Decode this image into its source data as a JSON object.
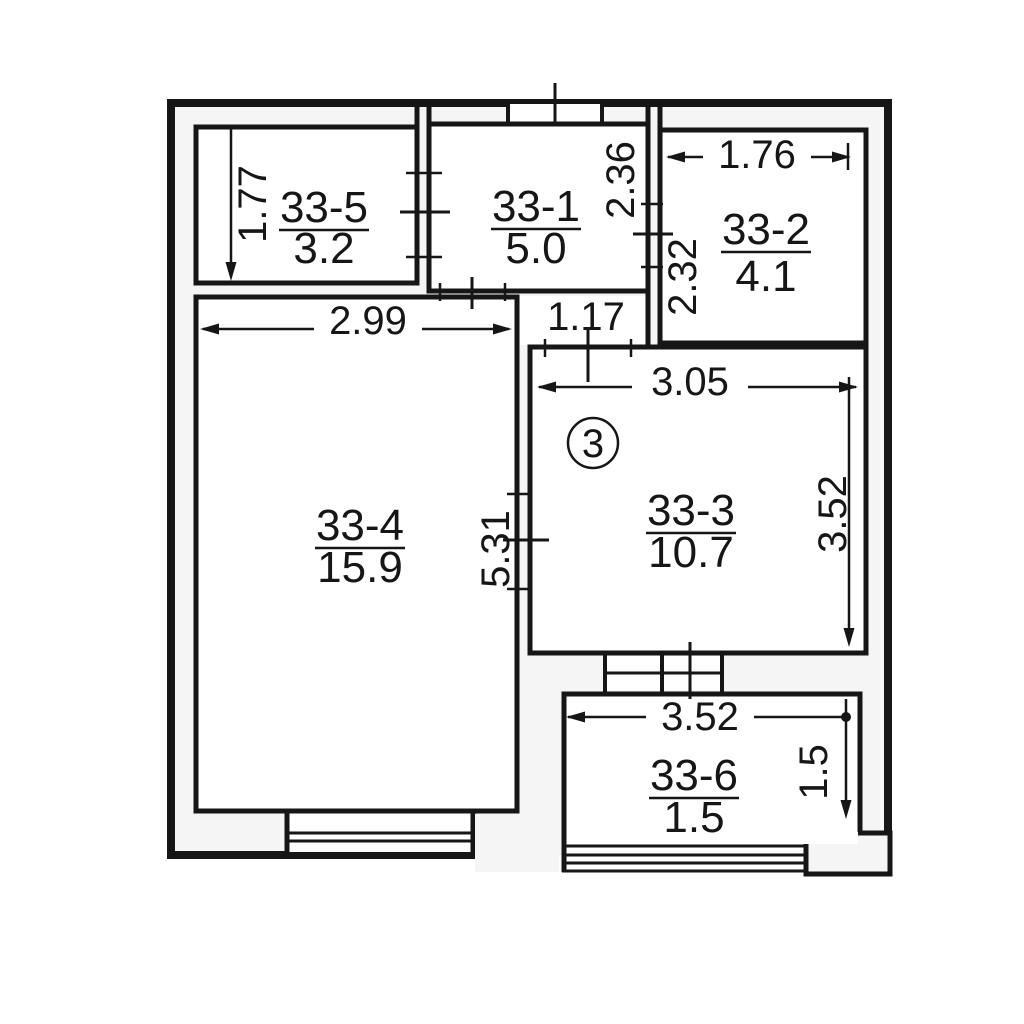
{
  "plan": {
    "unit_badge": "3",
    "rooms": [
      {
        "id": "33-5",
        "area": "3.2"
      },
      {
        "id": "33-1",
        "area": "5.0"
      },
      {
        "id": "33-2",
        "area": "4.1"
      },
      {
        "id": "33-4",
        "area": "15.9"
      },
      {
        "id": "33-3",
        "area": "10.7"
      },
      {
        "id": "33-6",
        "area": "1.5"
      }
    ],
    "dimensions": {
      "room5_height": "1.77",
      "room4_width": "2.99",
      "room4_height": "5.31",
      "corridor_width": "1.17",
      "wall12_upper": "2.36",
      "wall12_lower": "2.32",
      "room2_width": "1.76",
      "room3_width": "3.05",
      "room3_height": "3.52",
      "balcony_width": "3.52",
      "balcony_height": "1.5"
    },
    "colors": {
      "line": "#161616",
      "background": "#ffffff",
      "cavity": "#f5f5f5"
    }
  }
}
